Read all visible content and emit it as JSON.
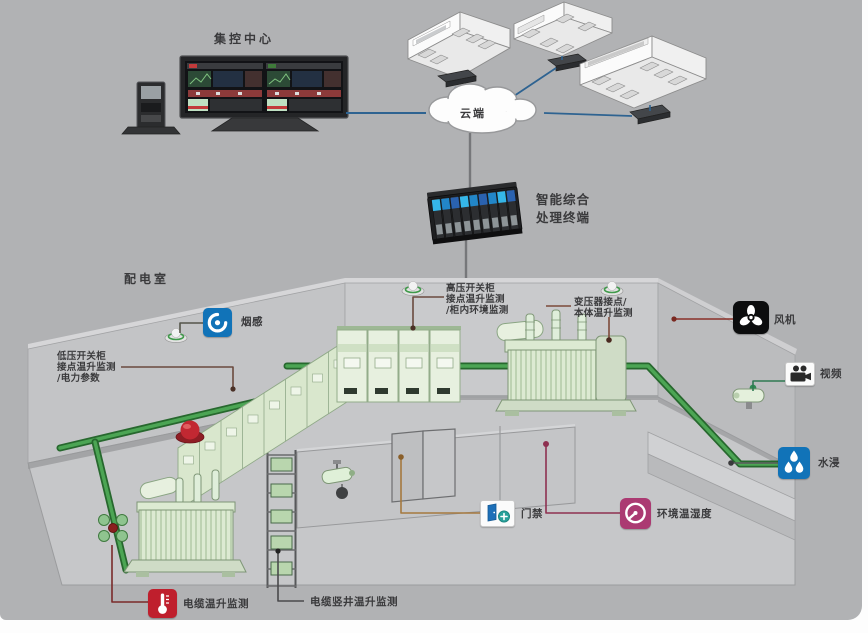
{
  "colors": {
    "background": "#b1b2b4",
    "network_line_blue": "#2e6391",
    "cable_tray_green": "#3f9a46",
    "sensor_icon_blue": "#1173b8",
    "env_icon_magenta": "#ab3a72",
    "alert_icon_red": "#bf1f2d",
    "equipment_pale_green": "#e3eed9"
  },
  "top": {
    "control_center_label": "集控中心",
    "cloud_label": "云端",
    "terminal_label_line1": "智能综合",
    "terminal_label_line2": "处理终端"
  },
  "room": {
    "title": "配电室",
    "callouts": {
      "smoke": "烟感",
      "hv_line1": "高压开关柜",
      "hv_line2": "接点温升监测",
      "hv_line3": "/柜内环境监测",
      "transformer_line1": "变压器接点/",
      "transformer_line2": "本体温升监测",
      "fan": "风机",
      "video": "视频",
      "water": "水浸",
      "lv_line1": "低压开关柜",
      "lv_line2": "接点温升监测",
      "lv_line3": "/电力参数",
      "door": "门禁",
      "env": "环境温湿度",
      "cable": "电缆温升监测",
      "shaft": "电缆竖井温升监测"
    }
  }
}
